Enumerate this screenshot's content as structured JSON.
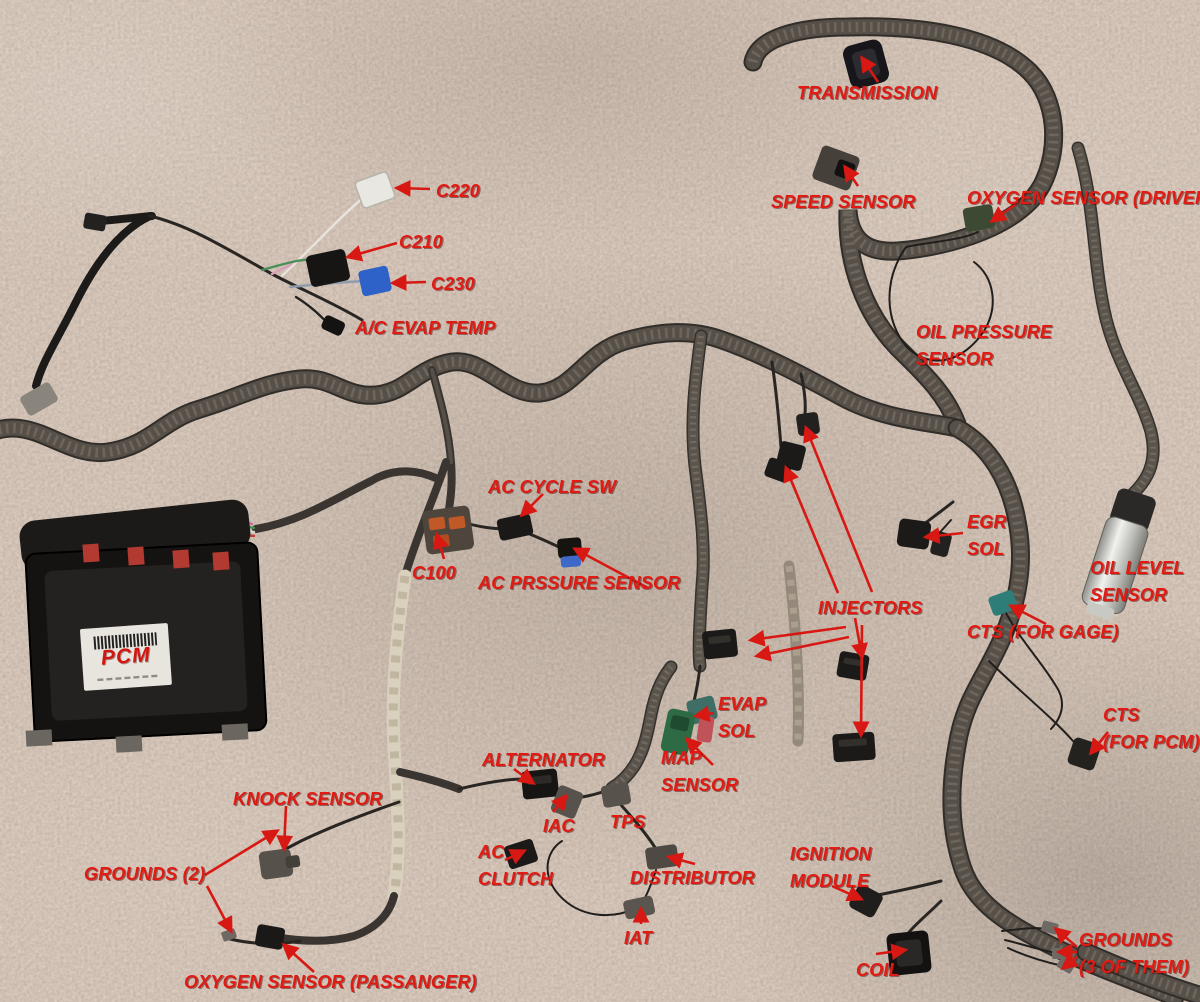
{
  "colors": {
    "annotation_red": "#e21a14",
    "arrow_red": "#d81812",
    "carpet_base": "#8e7b6c"
  },
  "pcm_sticker": {
    "text": "PCM"
  },
  "labels": [
    {
      "id": "transmission",
      "lines": [
        "TRANSMISSION"
      ],
      "x": 797,
      "y": 80
    },
    {
      "id": "speed-sensor",
      "lines": [
        "SPEED SENSOR"
      ],
      "x": 771,
      "y": 189
    },
    {
      "id": "oxygen-sensor-drivers",
      "lines": [
        "OXYGEN SENSOR (DRIVERS)"
      ],
      "x": 967,
      "y": 185
    },
    {
      "id": "c220",
      "lines": [
        "C220"
      ],
      "x": 436,
      "y": 178
    },
    {
      "id": "c210",
      "lines": [
        "C210"
      ],
      "x": 399,
      "y": 229
    },
    {
      "id": "c230",
      "lines": [
        "C230"
      ],
      "x": 431,
      "y": 271
    },
    {
      "id": "ac-evap-temp",
      "lines": [
        "A/C EVAP TEMP"
      ],
      "x": 355,
      "y": 315
    },
    {
      "id": "oil-pressure-sensor",
      "lines": [
        "OIL PRESSURE",
        "SENSOR"
      ],
      "x": 916,
      "y": 319
    },
    {
      "id": "ac-cycle-sw",
      "lines": [
        "AC CYCLE SW"
      ],
      "x": 488,
      "y": 474
    },
    {
      "id": "c100",
      "lines": [
        "C100"
      ],
      "x": 412,
      "y": 560
    },
    {
      "id": "ac-prssure-sensor",
      "lines": [
        "AC PRSSURE SENSOR"
      ],
      "x": 478,
      "y": 570
    },
    {
      "id": "egr-sol",
      "lines": [
        "EGR",
        "SOL"
      ],
      "x": 967,
      "y": 509
    },
    {
      "id": "oil-level-sensor",
      "lines": [
        "OIL LEVEL",
        "SENSOR"
      ],
      "x": 1090,
      "y": 555
    },
    {
      "id": "injectors",
      "lines": [
        "INJECTORS"
      ],
      "x": 818,
      "y": 595
    },
    {
      "id": "cts-for-gage",
      "lines": [
        "CTS (FOR GAGE)"
      ],
      "x": 967,
      "y": 619
    },
    {
      "id": "evap-sol",
      "lines": [
        "EVAP",
        "SOL"
      ],
      "x": 718,
      "y": 691
    },
    {
      "id": "map-sensor",
      "lines": [
        "MAP",
        "SENSOR"
      ],
      "x": 661,
      "y": 745
    },
    {
      "id": "cts-for-pcm",
      "lines": [
        "CTS",
        "(FOR PCM)"
      ],
      "x": 1103,
      "y": 702
    },
    {
      "id": "alternator",
      "lines": [
        "ALTERNATOR"
      ],
      "x": 482,
      "y": 747
    },
    {
      "id": "iac",
      "lines": [
        "IAC"
      ],
      "x": 543,
      "y": 813
    },
    {
      "id": "tps",
      "lines": [
        "TPS"
      ],
      "x": 610,
      "y": 809
    },
    {
      "id": "knock-sensor",
      "lines": [
        "KNOCK SENSOR"
      ],
      "x": 233,
      "y": 786
    },
    {
      "id": "grounds-2",
      "lines": [
        "GROUNDS (2)"
      ],
      "x": 84,
      "y": 861
    },
    {
      "id": "ac-clutch",
      "lines": [
        "AC",
        "CLUTCH"
      ],
      "x": 478,
      "y": 839
    },
    {
      "id": "distributor",
      "lines": [
        "DISTRIBUTOR"
      ],
      "x": 630,
      "y": 865
    },
    {
      "id": "ignition-module",
      "lines": [
        "IGNITION",
        "MODULE"
      ],
      "x": 790,
      "y": 841
    },
    {
      "id": "iat",
      "lines": [
        "IAT"
      ],
      "x": 624,
      "y": 925
    },
    {
      "id": "oxygen-sensor-passanger",
      "lines": [
        "OXYGEN SENSOR (PASSANGER)"
      ],
      "x": 184,
      "y": 969
    },
    {
      "id": "coil",
      "lines": [
        "COIL"
      ],
      "x": 856,
      "y": 957
    },
    {
      "id": "grounds-3",
      "lines": [
        "GROUNDS",
        "(3 OF THEM)"
      ],
      "x": 1079,
      "y": 927
    }
  ],
  "arrows": [
    {
      "from": "transmission",
      "x1": 878,
      "y1": 82,
      "x2": 862,
      "y2": 58
    },
    {
      "from": "speed-sensor",
      "x1": 858,
      "y1": 186,
      "x2": 845,
      "y2": 167
    },
    {
      "from": "oxygen-sensor-drivers",
      "x1": 1016,
      "y1": 204,
      "x2": 992,
      "y2": 221
    },
    {
      "from": "c220",
      "x1": 430,
      "y1": 189,
      "x2": 397,
      "y2": 188
    },
    {
      "from": "c210",
      "x1": 397,
      "y1": 243,
      "x2": 348,
      "y2": 257
    },
    {
      "from": "c230",
      "x1": 426,
      "y1": 282,
      "x2": 393,
      "y2": 283
    },
    {
      "from": "ac-cycle-sw",
      "x1": 543,
      "y1": 494,
      "x2": 522,
      "y2": 515
    },
    {
      "from": "c100",
      "x1": 444,
      "y1": 559,
      "x2": 437,
      "y2": 535
    },
    {
      "from": "ac-prssure-sensor",
      "x1": 648,
      "y1": 588,
      "x2": 575,
      "y2": 549
    },
    {
      "from": "egr-sol",
      "x1": 963,
      "y1": 533,
      "x2": 926,
      "y2": 537
    },
    {
      "from": "injectors",
      "x1": 838,
      "y1": 593,
      "x2": 786,
      "y2": 468
    },
    {
      "from": "injectors",
      "x1": 872,
      "y1": 592,
      "x2": 806,
      "y2": 428
    },
    {
      "from": "injectors",
      "x1": 846,
      "y1": 627,
      "x2": 751,
      "y2": 640
    },
    {
      "from": "injectors",
      "x1": 849,
      "y1": 637,
      "x2": 757,
      "y2": 656
    },
    {
      "from": "injectors",
      "x1": 855,
      "y1": 618,
      "x2": 862,
      "y2": 657
    },
    {
      "from": "injectors",
      "x1": 862,
      "y1": 625,
      "x2": 861,
      "y2": 735
    },
    {
      "from": "cts-for-gage",
      "x1": 1046,
      "y1": 624,
      "x2": 1011,
      "y2": 606
    },
    {
      "from": "evap-sol",
      "x1": 714,
      "y1": 713,
      "x2": 696,
      "y2": 716
    },
    {
      "from": "map-sensor",
      "x1": 713,
      "y1": 765,
      "x2": 687,
      "y2": 739
    },
    {
      "from": "cts-for-pcm",
      "x1": 1108,
      "y1": 732,
      "x2": 1091,
      "y2": 753
    },
    {
      "from": "alternator",
      "x1": 514,
      "y1": 769,
      "x2": 533,
      "y2": 783
    },
    {
      "from": "iac",
      "x1": 553,
      "y1": 812,
      "x2": 566,
      "y2": 796
    },
    {
      "from": "knock-sensor",
      "x1": 286,
      "y1": 806,
      "x2": 284,
      "y2": 849
    },
    {
      "from": "grounds-2",
      "x1": 205,
      "y1": 875,
      "x2": 277,
      "y2": 831
    },
    {
      "from": "grounds-2",
      "x1": 207,
      "y1": 886,
      "x2": 231,
      "y2": 931
    },
    {
      "from": "ac-clutch",
      "x1": 505,
      "y1": 860,
      "x2": 524,
      "y2": 851
    },
    {
      "from": "distributor",
      "x1": 695,
      "y1": 864,
      "x2": 669,
      "y2": 857
    },
    {
      "from": "ignition-module",
      "x1": 832,
      "y1": 886,
      "x2": 861,
      "y2": 899
    },
    {
      "from": "iat",
      "x1": 641,
      "y1": 924,
      "x2": 641,
      "y2": 909
    },
    {
      "from": "oxygen-sensor-passanger",
      "x1": 314,
      "y1": 972,
      "x2": 284,
      "y2": 945
    },
    {
      "from": "coil",
      "x1": 876,
      "y1": 954,
      "x2": 905,
      "y2": 950
    },
    {
      "from": "grounds-3",
      "x1": 1077,
      "y1": 947,
      "x2": 1056,
      "y2": 929
    },
    {
      "from": "grounds-3",
      "x1": 1077,
      "y1": 952,
      "x2": 1059,
      "y2": 952
    },
    {
      "from": "grounds-3",
      "x1": 1077,
      "y1": 957,
      "x2": 1063,
      "y2": 968
    }
  ]
}
